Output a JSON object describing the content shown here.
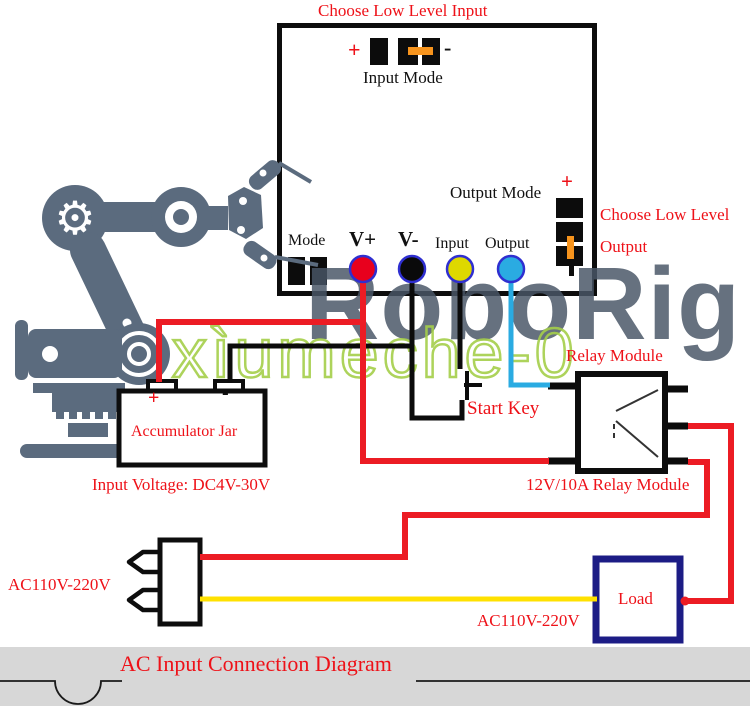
{
  "board": {
    "title_top": "Choose Low Level Input",
    "input_mode": {
      "plus": "+",
      "minus": "-",
      "label": "Input Mode"
    },
    "output_mode": {
      "label": "Output Mode",
      "plus": "+",
      "minus": "-"
    },
    "choose_output_line1": "Choose Low Level",
    "choose_output_line2": "Output",
    "terminals": {
      "mode": "Mode",
      "v_plus": "V+",
      "v_minus": "V-",
      "input": "Input",
      "output": "Output"
    }
  },
  "watermarks": {
    "brand": "RoboRig",
    "shop": "xìumeche-0"
  },
  "accumulator": {
    "plus": "+",
    "minus": "-",
    "label": "Accumulator Jar",
    "caption": "Input Voltage: DC4V-30V"
  },
  "relay": {
    "title": "Relay Module",
    "caption": "12V/10A Relay Module"
  },
  "start_key_label": "Start Key",
  "ac_plug": {
    "label": "AC110V-220V"
  },
  "load": {
    "label": "Load",
    "caption": "AC110V-220V"
  },
  "footer": {
    "title": "AC Input Connection Diagram"
  },
  "colors": {
    "wire_red": "#ec1c24",
    "wire_black": "#0b0b0b",
    "wire_yellow": "#ffe100",
    "wire_cyan": "#2aabe2",
    "load_border": "#1c1c85",
    "label_red": "#ee1118",
    "robot_gray": "#5b6b7e",
    "jumper_orange": "#f7941d",
    "watermark_green": "#a5cf4a"
  }
}
